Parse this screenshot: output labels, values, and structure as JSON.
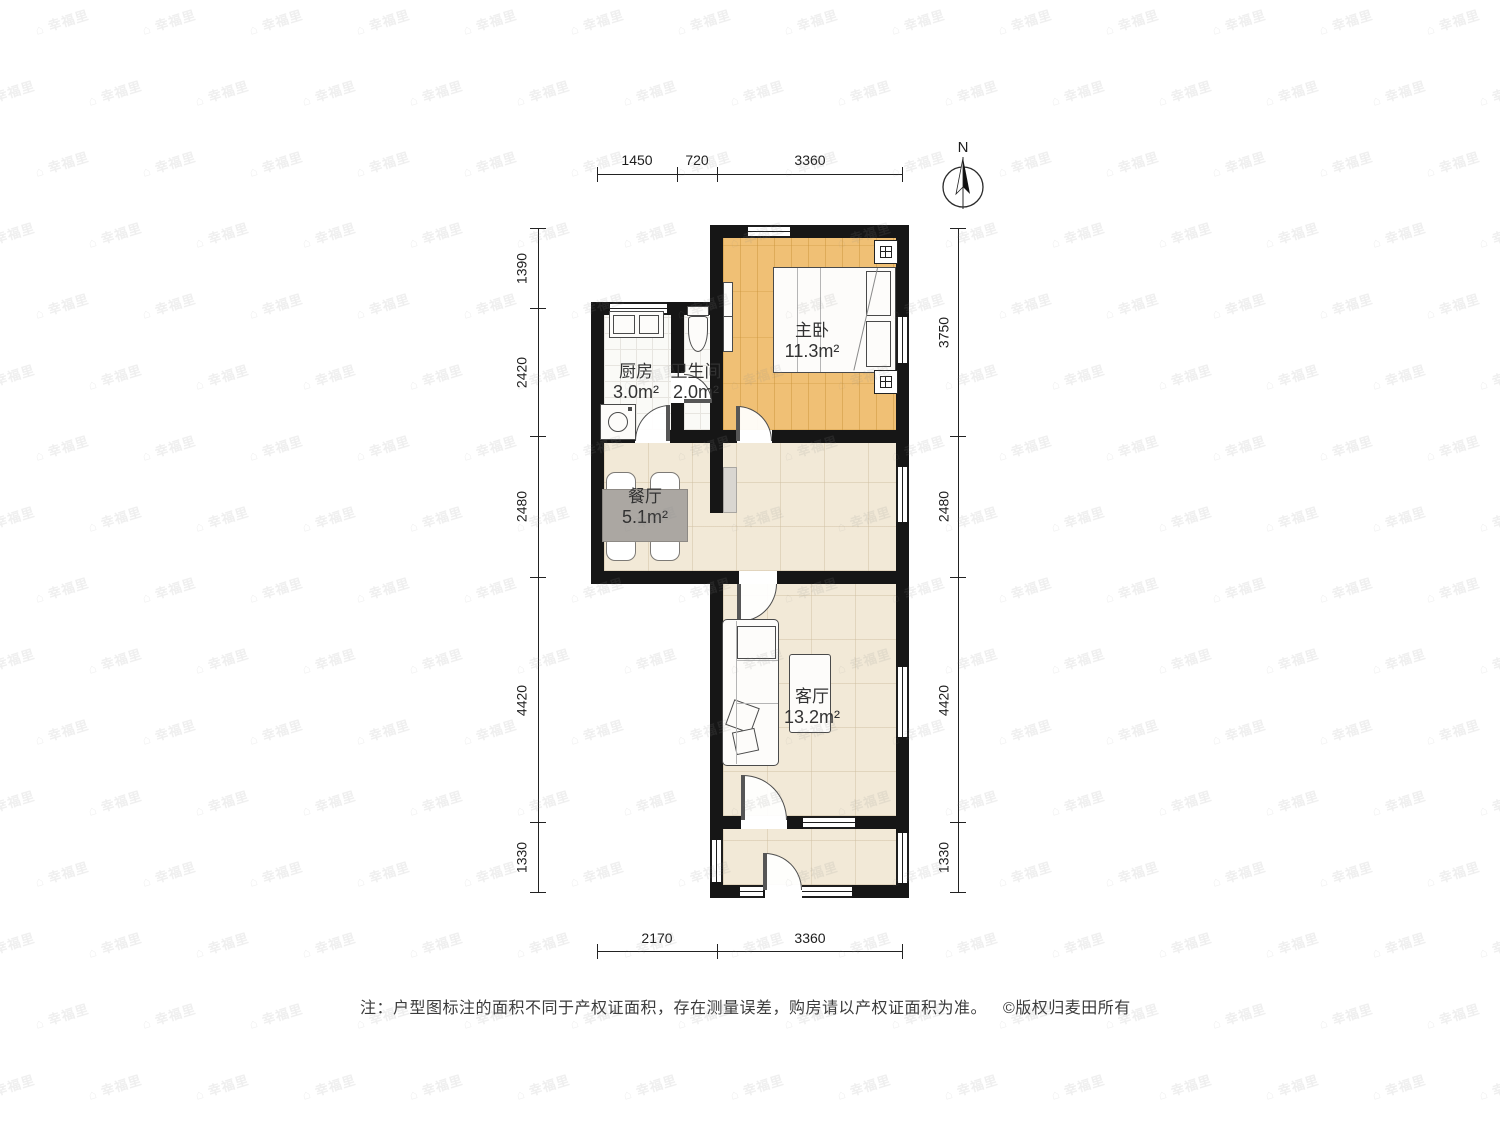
{
  "meta": {
    "compass_label": "N",
    "watermark_text": "幸福里",
    "note": "注：户型图标注的面积不同于产权证面积，存在测量误差，购房请以产权证面积为准。",
    "copyright": "©版权归麦田所有"
  },
  "rooms": [
    {
      "name": "主卧",
      "area": "11.3m²"
    },
    {
      "name": "厨房",
      "area": "3.0m²"
    },
    {
      "name": "卫生间",
      "area": "2.0m²"
    },
    {
      "name": "餐厅",
      "area": "5.1m²"
    },
    {
      "name": "客厅",
      "area": "13.2m²"
    }
  ],
  "dimensions": {
    "top": [
      "1450",
      "720",
      "3360"
    ],
    "bottom": [
      "2170",
      "3360"
    ],
    "left": [
      "1390",
      "2420",
      "2480",
      "4420",
      "1330"
    ],
    "right": [
      "3750",
      "2480",
      "4420",
      "1330"
    ]
  },
  "colors": {
    "wall": "#161616",
    "plank": "#F0C075",
    "tile": "#FAFAF7",
    "wood": "#F2E9D7",
    "table": "#ABA7A2"
  }
}
